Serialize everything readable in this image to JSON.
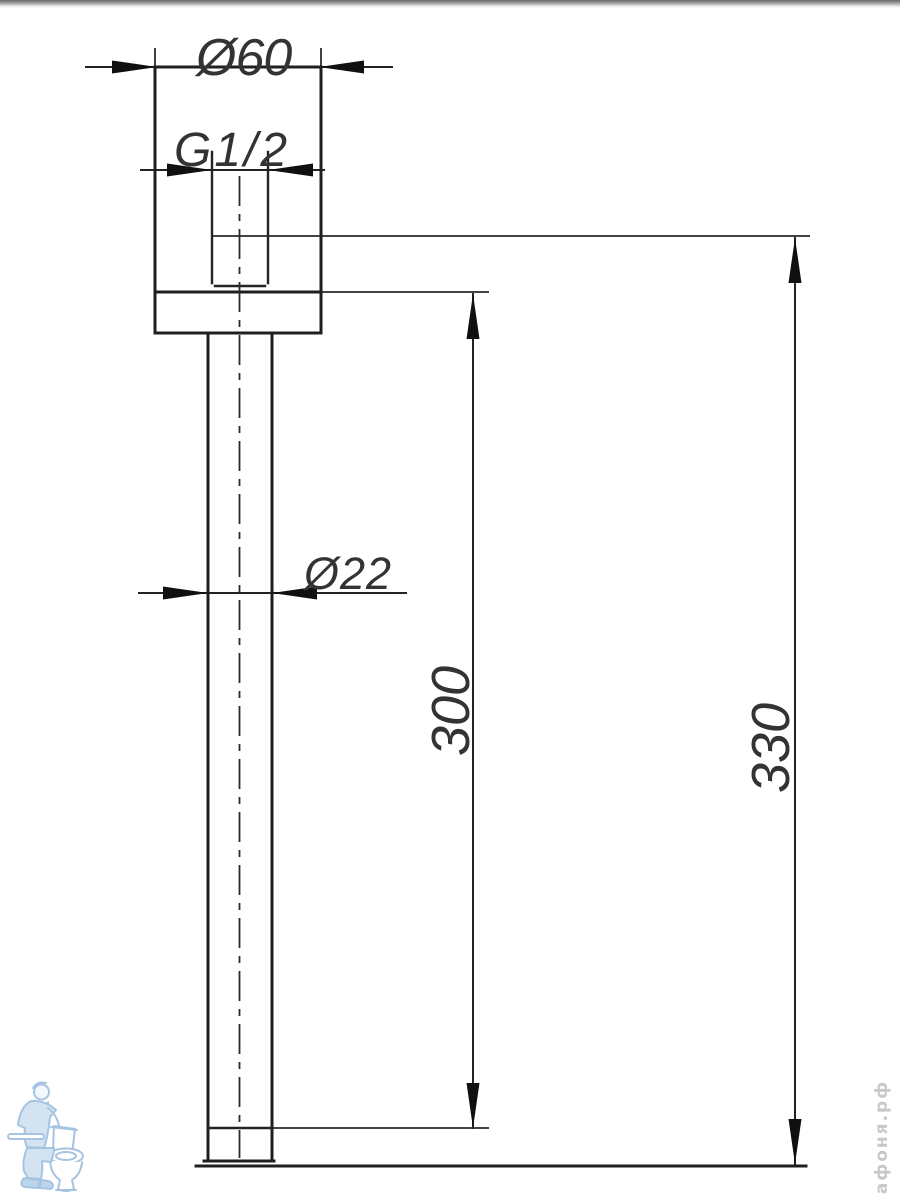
{
  "drawing": {
    "type": "technical-dimension-drawing",
    "dimensions": {
      "flange_diameter": "Ø60",
      "thread_size": "G1/2",
      "pipe_diameter": "Ø22",
      "arm_length": "300",
      "overall_length": "330"
    }
  },
  "watermark": {
    "text": "афоня.рф"
  },
  "logo": {
    "name": "plumber-with-toilet-mascot"
  },
  "colors": {
    "line": "#1f1f1f",
    "watermark": "#c8c8cc",
    "logo_blue": "#a6c4e2",
    "background": "#ffffff"
  }
}
